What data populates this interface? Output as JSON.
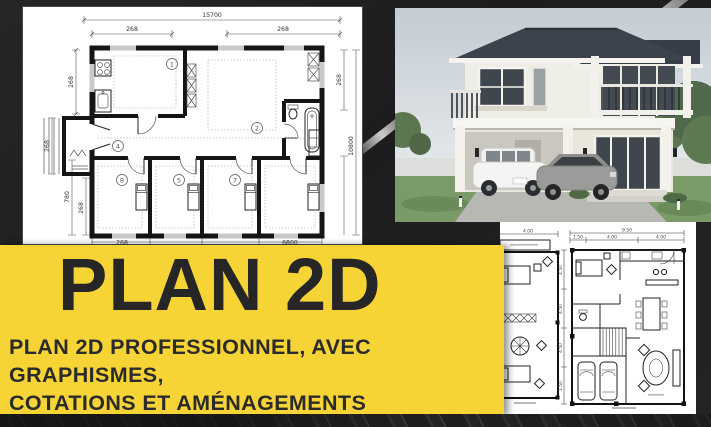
{
  "banner": {
    "title": "PLAN 2D",
    "subtitle_line1": "PLAN 2D PROFESSIONNEL, AVEC GRAPHISMES,",
    "subtitle_line2": "COTATIONS ET AMÉNAGEMENTS",
    "bg_color": "#F7D435",
    "text_color": "#262626"
  },
  "main_plan": {
    "dim_top_total": "15700",
    "dim_top_left": "268",
    "dim_top_right": "268",
    "dim_left_upper": "268",
    "dim_left_porch": "268",
    "dim_left_lower": "780",
    "dim_left_lower_inner": "268",
    "dim_right_upper": "268",
    "dim_right_total": "10800",
    "dim_bottom_left": "268",
    "dim_bottom_right": "6800",
    "room_numbers": [
      "1",
      "2",
      "4",
      "8",
      "5",
      "7"
    ]
  },
  "small_plan_left": {
    "dim_top": "4.00"
  },
  "small_plan_right": {
    "dim_top_total": "9.50",
    "dim_top_segments": [
      "1.50",
      "4.00",
      "4.00"
    ],
    "dim_left_segments": [
      "4.50",
      "4.50",
      "4.50",
      "1.50"
    ]
  }
}
